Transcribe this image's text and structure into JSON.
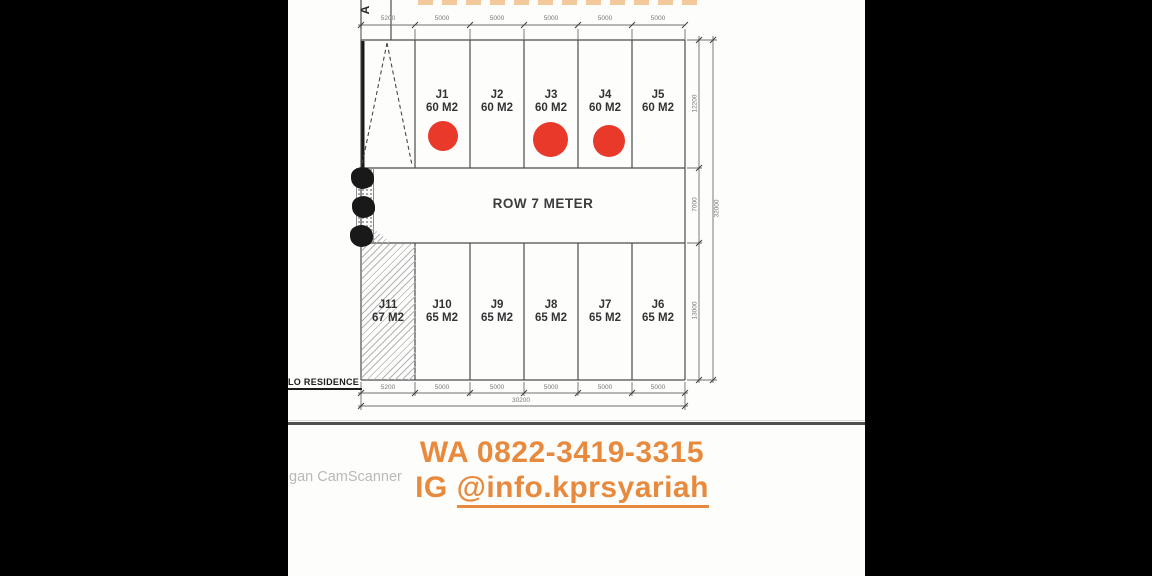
{
  "plan": {
    "road_marker": "A",
    "row_label": "ROW 7 METER",
    "residence_label": "LO RESIDENCE",
    "top_dimensions": [
      "5200",
      "5000",
      "5000",
      "5000",
      "5000",
      "5000"
    ],
    "bottom_dimensions": [
      "5200",
      "5000",
      "5000",
      "5000",
      "5000",
      "5000"
    ],
    "total_width": "30200",
    "side_dimensions": {
      "top_row": "12200",
      "middle_row": "7000",
      "bottom_row": "13000",
      "total": "32000"
    },
    "lots_top": [
      {
        "id": "J1",
        "area": "60 M2",
        "sold": true
      },
      {
        "id": "J2",
        "area": "60 M2",
        "sold": false
      },
      {
        "id": "J3",
        "area": "60 M2",
        "sold": true
      },
      {
        "id": "J4",
        "area": "60 M2",
        "sold": true
      },
      {
        "id": "J5",
        "area": "60 M2",
        "sold": false
      }
    ],
    "lots_bottom": [
      {
        "id": "J11",
        "area": "67 M2",
        "sold": false
      },
      {
        "id": "J10",
        "area": "65 M2",
        "sold": false
      },
      {
        "id": "J9",
        "area": "65 M2",
        "sold": false
      },
      {
        "id": "J8",
        "area": "65 M2",
        "sold": false
      },
      {
        "id": "J7",
        "area": "65 M2",
        "sold": false
      },
      {
        "id": "J6",
        "area": "65 M2",
        "sold": false
      }
    ]
  },
  "contact": {
    "whatsapp": "WA 0822-3419-3315",
    "instagram_prefix": "IG ",
    "instagram_handle": "@info.kprsyariah"
  },
  "watermark": "gan CamScanner",
  "colors": {
    "accent_orange": "#E88A3D",
    "sold_red": "#E9392B",
    "drawing_line": "#4d4d4d"
  }
}
